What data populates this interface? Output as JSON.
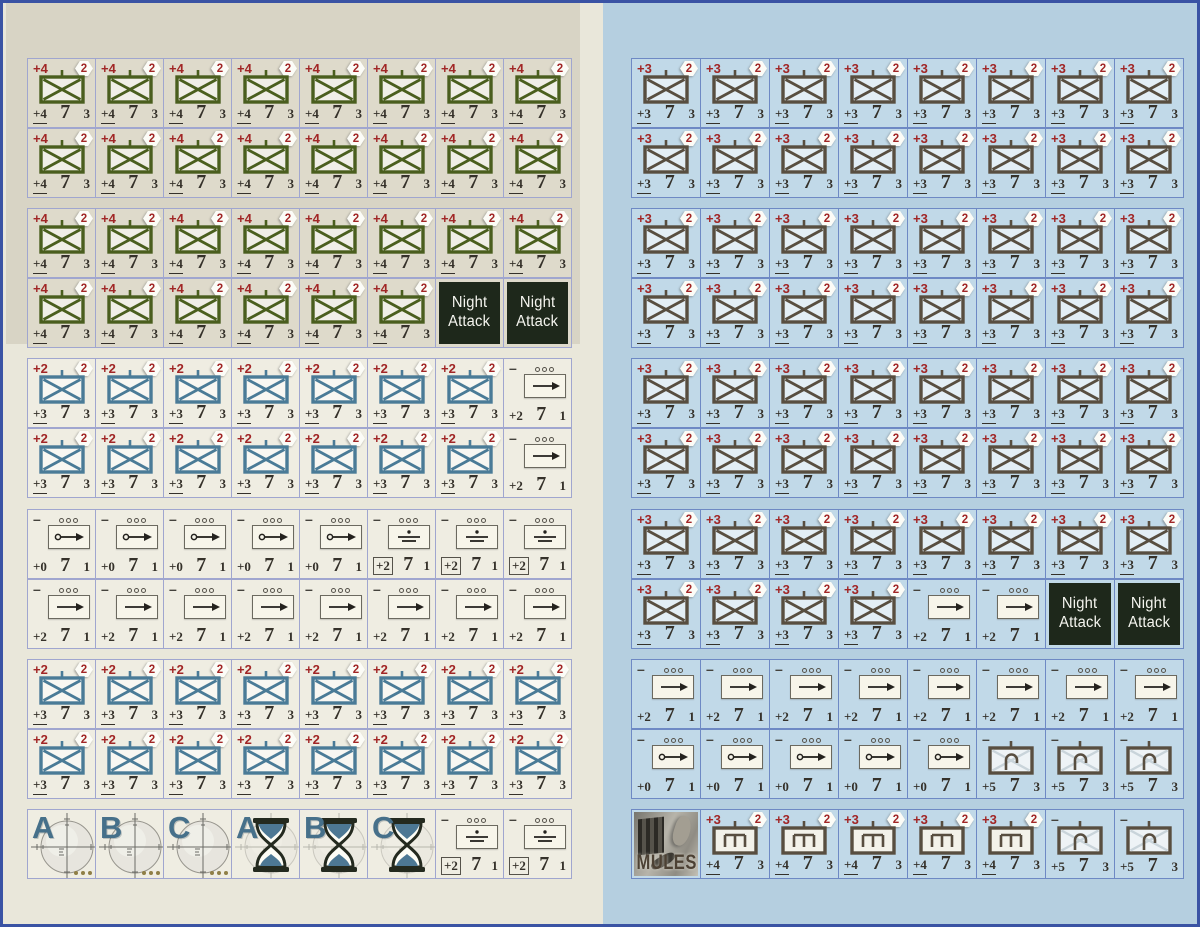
{
  "page": {
    "border_color": "#3a53a4",
    "left_sheet_bg": "#e9e7da",
    "left_sheet_top_block_bg": "#d8d4c5",
    "right_sheet_bg": "#b5cfe0",
    "accent_red": "#a12626",
    "night_counter_bg": "#1e281b"
  },
  "types": {
    "inf_green": {
      "kind": "inf",
      "name": "counter-infantry-green",
      "color": "#4a5e1e",
      "mod": "+4",
      "badge": "2",
      "v1": "+4",
      "v2": "7",
      "v3": "3",
      "underline": true
    },
    "inf_blue": {
      "kind": "inf",
      "name": "counter-infantry-blue",
      "color": "#4a7b97",
      "mod": "+2",
      "badge": "2",
      "v1": "+3",
      "v2": "7",
      "v3": "3",
      "underline": true
    },
    "inf_brown": {
      "kind": "inf",
      "name": "counter-infantry-brown",
      "color": "#584e40",
      "mod": "+3",
      "badge": "2",
      "v1": "+3",
      "v2": "7",
      "v3": "3",
      "underline": true
    },
    "mg": {
      "kind": "mg",
      "name": "counter-machinegun-brown",
      "color": "#584e40",
      "mod": "+3",
      "badge": "2",
      "v1": "+4",
      "v2": "7",
      "v3": "3",
      "underline": true
    },
    "mtn": {
      "kind": "mtn",
      "name": "counter-mountain-brown",
      "color": "#584e40",
      "mod": "–",
      "v1": "+5",
      "v2": "7",
      "v3": "3",
      "underline": false
    },
    "night": {
      "kind": "night",
      "name": "counter-night-attack",
      "line1": "Night",
      "line2": "Attack"
    },
    "truck_arrow": {
      "kind": "truck",
      "name": "counter-supply-column",
      "sym": "arrow",
      "mod": "–",
      "v1": "+2",
      "v2": "7",
      "v3": "1",
      "boxed": false
    },
    "truck_oarrow": {
      "kind": "truck",
      "name": "counter-wagon-column",
      "sym": "oarrow",
      "mod": "–",
      "v1": "+0",
      "v2": "7",
      "v3": "1",
      "boxed": false
    },
    "truck_supply": {
      "kind": "truck",
      "name": "counter-supply-dump",
      "sym": "supply",
      "mod": "–",
      "v1": "+2",
      "v2": "7",
      "v3": "1",
      "boxed": true
    },
    "scope_a": {
      "kind": "scope",
      "name": "counter-artillery-target-a",
      "letter": "A"
    },
    "scope_b": {
      "kind": "scope",
      "name": "counter-artillery-target-b",
      "letter": "B"
    },
    "scope_c": {
      "kind": "scope",
      "name": "counter-artillery-target-c",
      "letter": "C"
    },
    "hourglass_a": {
      "kind": "hourglass",
      "name": "counter-timer-a",
      "letter": "A"
    },
    "hourglass_b": {
      "kind": "hourglass",
      "name": "counter-timer-b",
      "letter": "B"
    },
    "hourglass_c": {
      "kind": "hourglass",
      "name": "counter-timer-c",
      "letter": "C"
    },
    "mules": {
      "kind": "mules",
      "name": "counter-mules",
      "label": "MULES"
    }
  },
  "sheets": {
    "left": {
      "rows": [
        [
          {
            "t": "inf_green",
            "n": 8
          }
        ],
        [
          {
            "t": "inf_green",
            "n": 8
          }
        ],
        [
          {
            "t": "inf_green",
            "n": 8
          }
        ],
        [
          {
            "t": "inf_green",
            "n": 6
          },
          {
            "t": "night",
            "n": 2
          }
        ],
        [
          {
            "t": "inf_blue",
            "n": 7
          },
          {
            "t": "truck_arrow",
            "n": 1
          }
        ],
        [
          {
            "t": "inf_blue",
            "n": 7
          },
          {
            "t": "truck_arrow",
            "n": 1
          }
        ],
        [
          {
            "t": "truck_oarrow",
            "n": 5
          },
          {
            "t": "truck_supply",
            "n": 3
          }
        ],
        [
          {
            "t": "truck_arrow",
            "n": 8
          }
        ],
        [
          {
            "t": "inf_blue",
            "n": 8
          }
        ],
        [
          {
            "t": "inf_blue",
            "n": 8
          }
        ],
        [
          {
            "t": "scope_a",
            "n": 1
          },
          {
            "t": "scope_b",
            "n": 1
          },
          {
            "t": "scope_c",
            "n": 1
          },
          {
            "t": "hourglass_a",
            "n": 1
          },
          {
            "t": "hourglass_b",
            "n": 1
          },
          {
            "t": "hourglass_c",
            "n": 1
          },
          {
            "t": "truck_supply",
            "n": 2
          }
        ]
      ]
    },
    "right": {
      "rows": [
        [
          {
            "t": "inf_brown",
            "n": 8
          }
        ],
        [
          {
            "t": "inf_brown",
            "n": 8
          }
        ],
        [
          {
            "t": "inf_brown",
            "n": 8
          }
        ],
        [
          {
            "t": "inf_brown",
            "n": 8
          }
        ],
        [
          {
            "t": "inf_brown",
            "n": 8
          }
        ],
        [
          {
            "t": "inf_brown",
            "n": 8
          }
        ],
        [
          {
            "t": "inf_brown",
            "n": 8
          }
        ],
        [
          {
            "t": "inf_brown",
            "n": 4
          },
          {
            "t": "truck_arrow",
            "n": 2
          },
          {
            "t": "night",
            "n": 2
          }
        ],
        [
          {
            "t": "truck_arrow",
            "n": 8
          }
        ],
        [
          {
            "t": "truck_oarrow",
            "n": 5
          },
          {
            "t": "mtn",
            "n": 3
          }
        ],
        [
          {
            "t": "mules",
            "n": 1
          },
          {
            "t": "mg",
            "n": 5
          },
          {
            "t": "mtn",
            "n": 2
          }
        ]
      ]
    }
  }
}
